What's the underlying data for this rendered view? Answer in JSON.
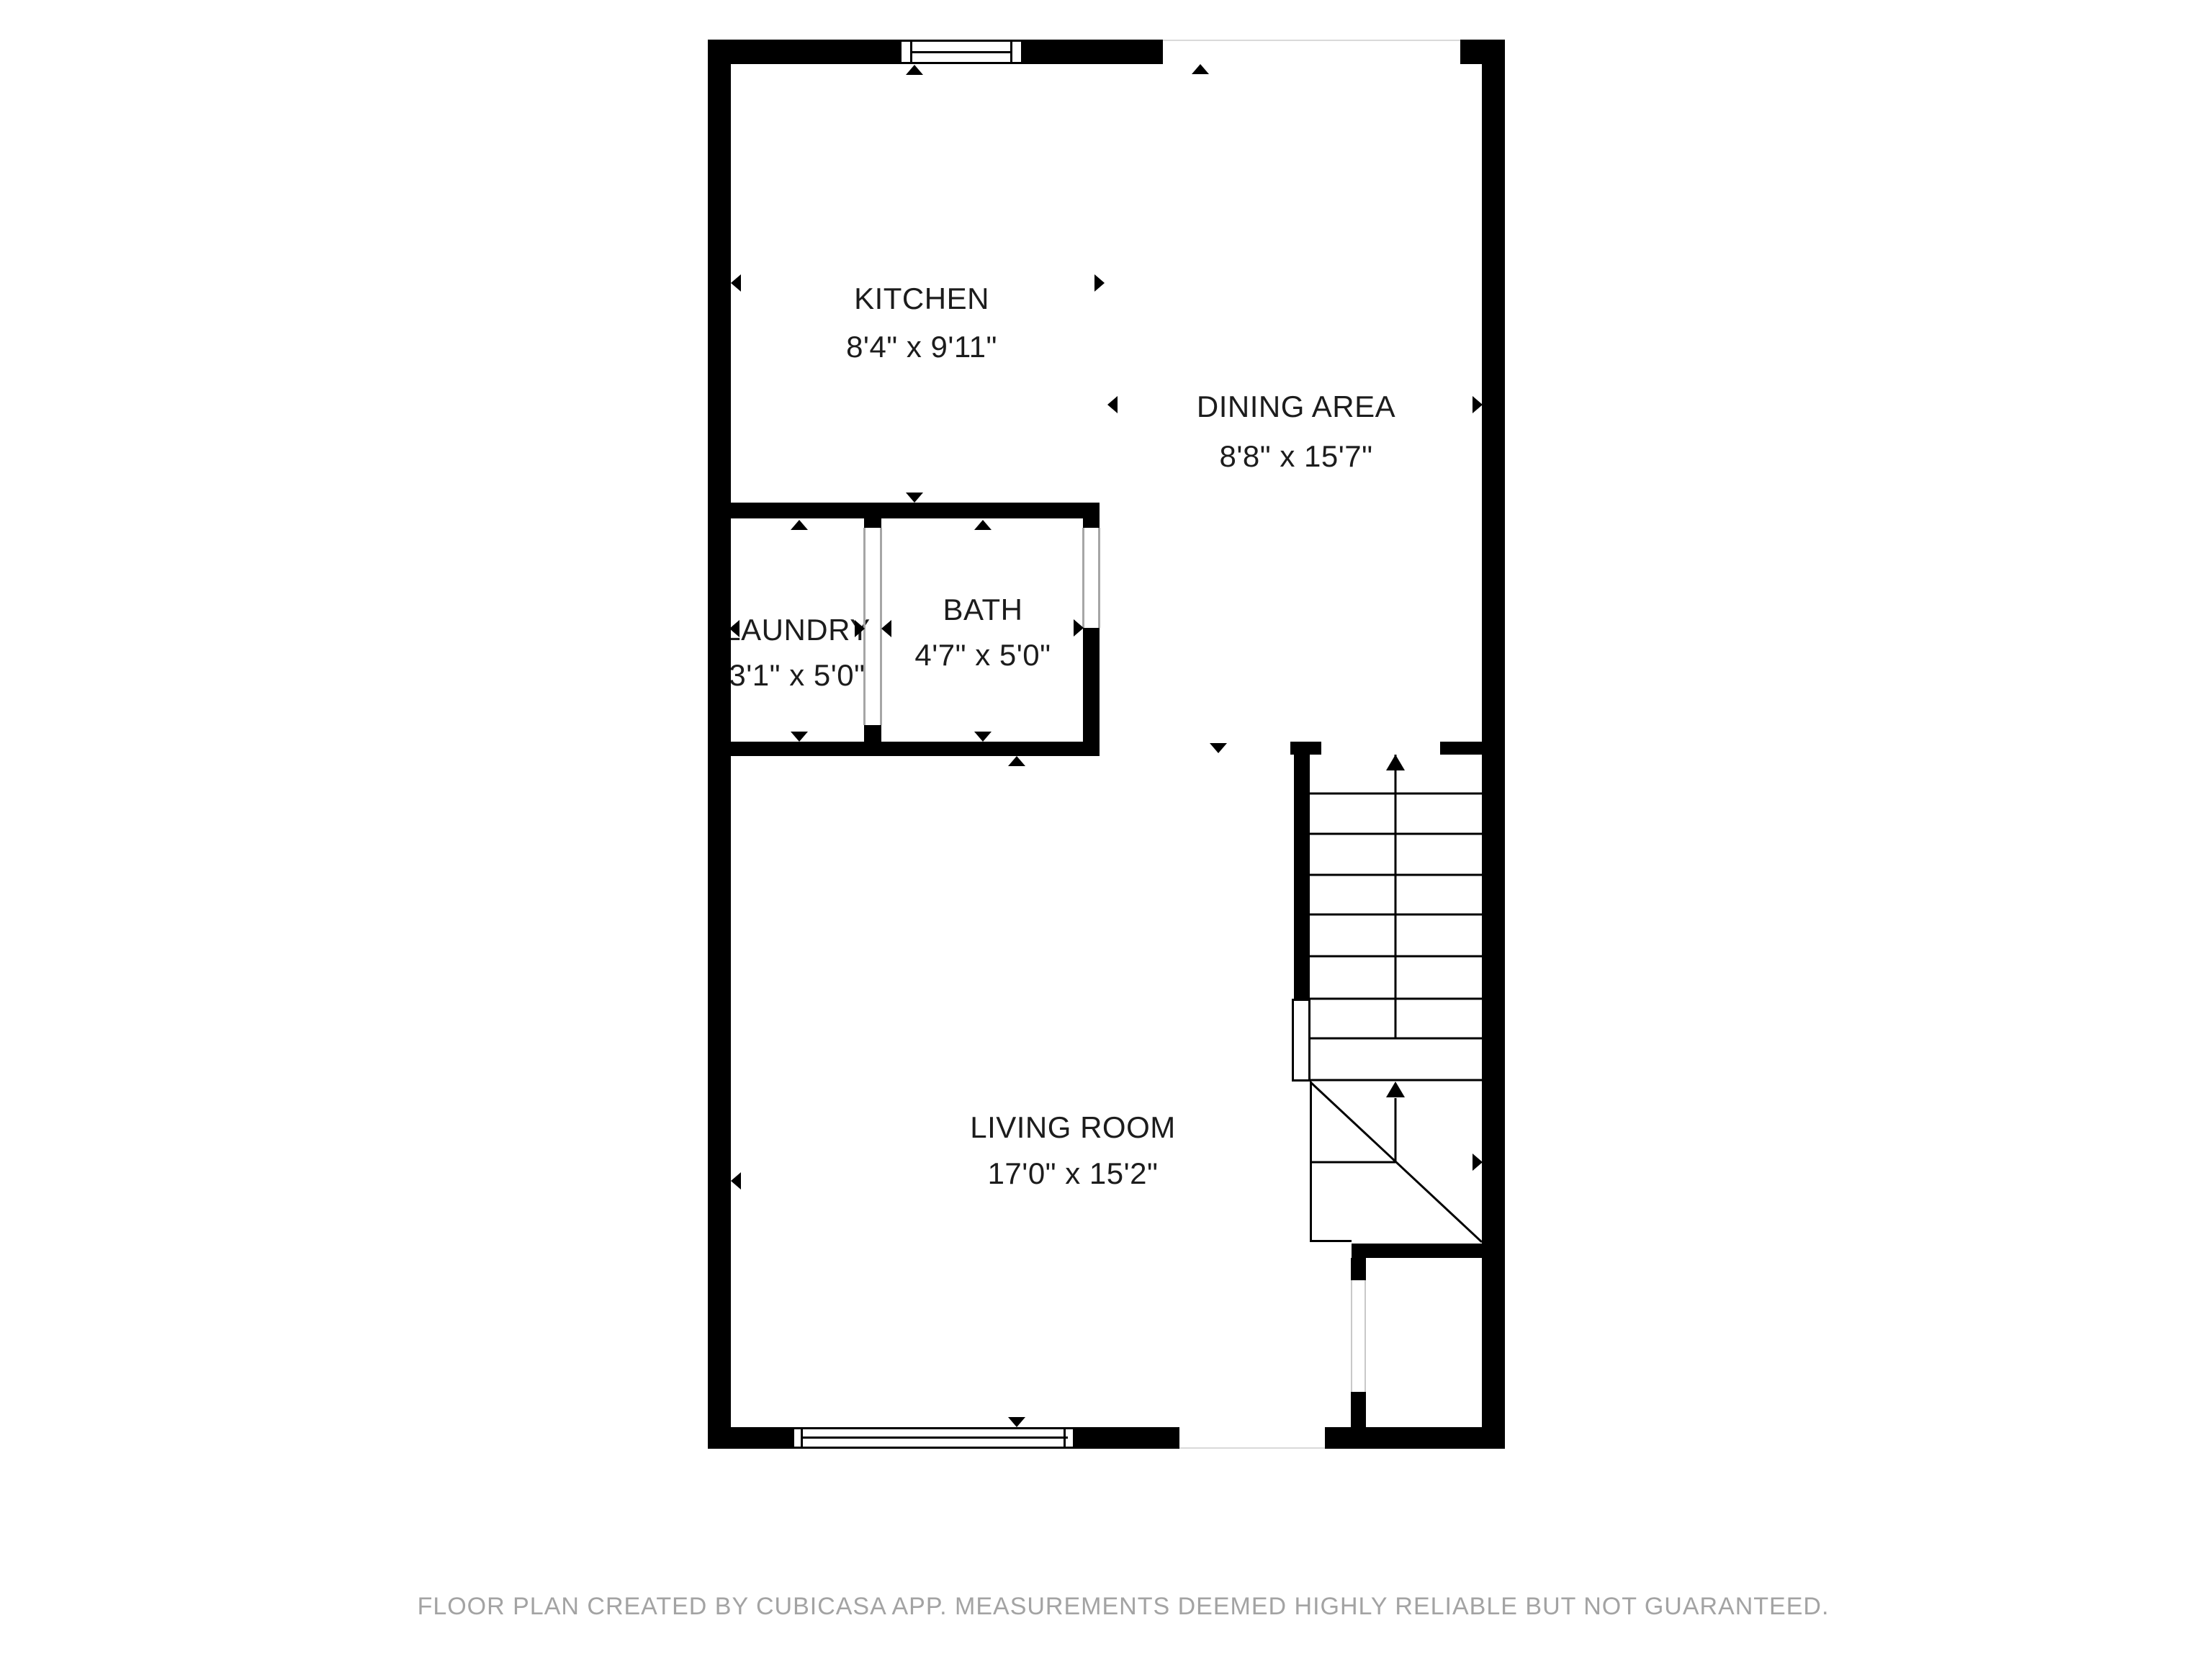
{
  "plan": {
    "rooms": [
      {
        "name": "KITCHEN",
        "dims": "8'4\" x 9'11\""
      },
      {
        "name": "DINING AREA",
        "dims": "8'8\" x 15'7\""
      },
      {
        "name": "LAUNDRY",
        "dims": "3'1\" x 5'0\""
      },
      {
        "name": "BATH",
        "dims": "4'7\" x 5'0\""
      },
      {
        "name": "LIVING ROOM",
        "dims": "17'0\" x 15'2\""
      }
    ],
    "stairs": {
      "direction_markers": "up-arrow",
      "flights": 2
    },
    "footer": "FLOOR PLAN CREATED BY CUBICASA APP. MEASUREMENTS DEEMED HIGHLY RELIABLE BUT NOT GUARANTEED.",
    "colors": {
      "wall": "#000000",
      "text": "#1c1c1c",
      "footer": "#a3a3a3",
      "jamb": "#a6a6a6",
      "hairline": "#d9d9d9",
      "bg": "#ffffff"
    }
  }
}
